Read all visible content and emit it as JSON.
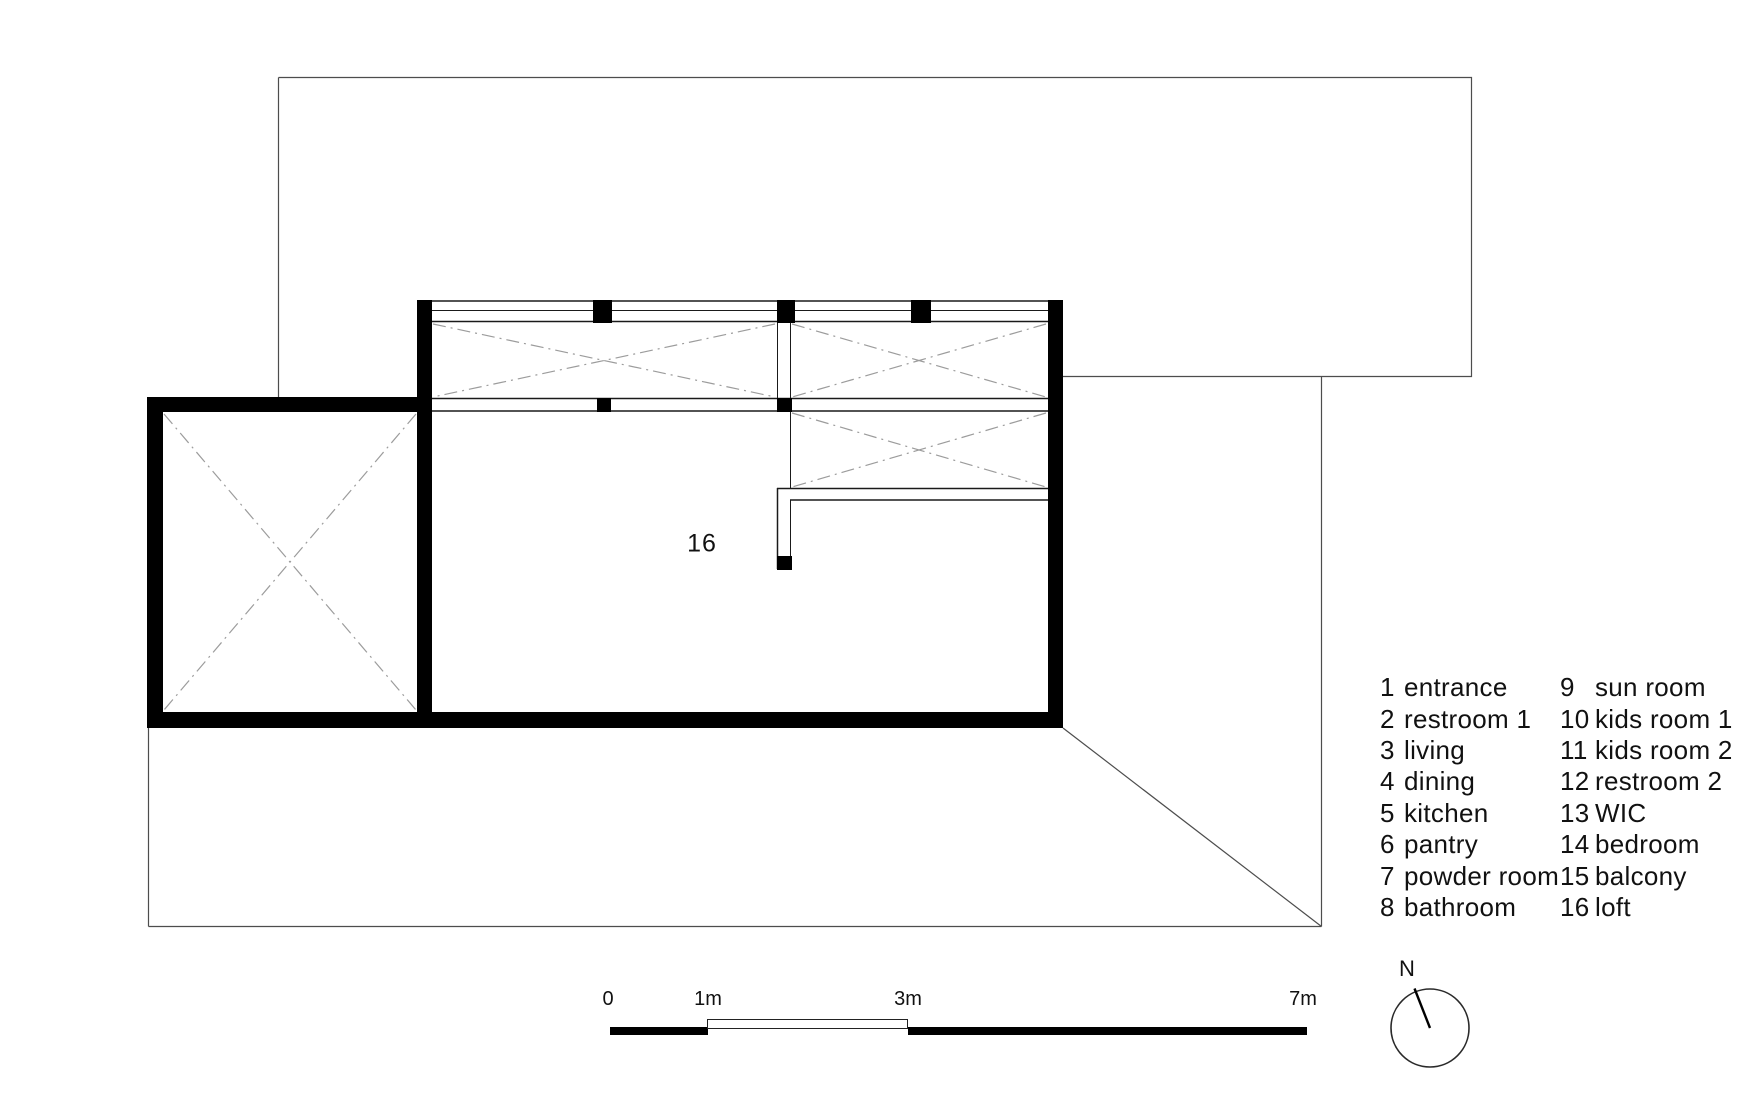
{
  "plan": {
    "room_label": "16"
  },
  "legend": {
    "columns": [
      {
        "items": [
          {
            "num": "1",
            "label": "entrance"
          },
          {
            "num": "2",
            "label": "restroom 1"
          },
          {
            "num": "3",
            "label": "living"
          },
          {
            "num": "4",
            "label": "dining"
          },
          {
            "num": "5",
            "label": "kitchen"
          },
          {
            "num": "6",
            "label": "pantry"
          },
          {
            "num": "7",
            "label": "powder room"
          },
          {
            "num": "8",
            "label": "bathroom"
          }
        ]
      },
      {
        "items": [
          {
            "num": "9",
            "label": "sun room"
          },
          {
            "num": "10",
            "label": "kids room 1"
          },
          {
            "num": "11",
            "label": "kids room 2"
          },
          {
            "num": "12",
            "label": "restroom 2"
          },
          {
            "num": "13",
            "label": "WIC"
          },
          {
            "num": "14",
            "label": "bedroom"
          },
          {
            "num": "15",
            "label": "balcony"
          },
          {
            "num": "16",
            "label": "loft"
          }
        ]
      }
    ]
  },
  "scale_bar": {
    "labels": [
      "0",
      "1m",
      "3m",
      "7m"
    ]
  },
  "north": {
    "label": "N"
  },
  "colors": {
    "wall": "#000000",
    "outline": "#4d4d4d",
    "hatch": "#9c9c9c",
    "text": "#111111"
  }
}
